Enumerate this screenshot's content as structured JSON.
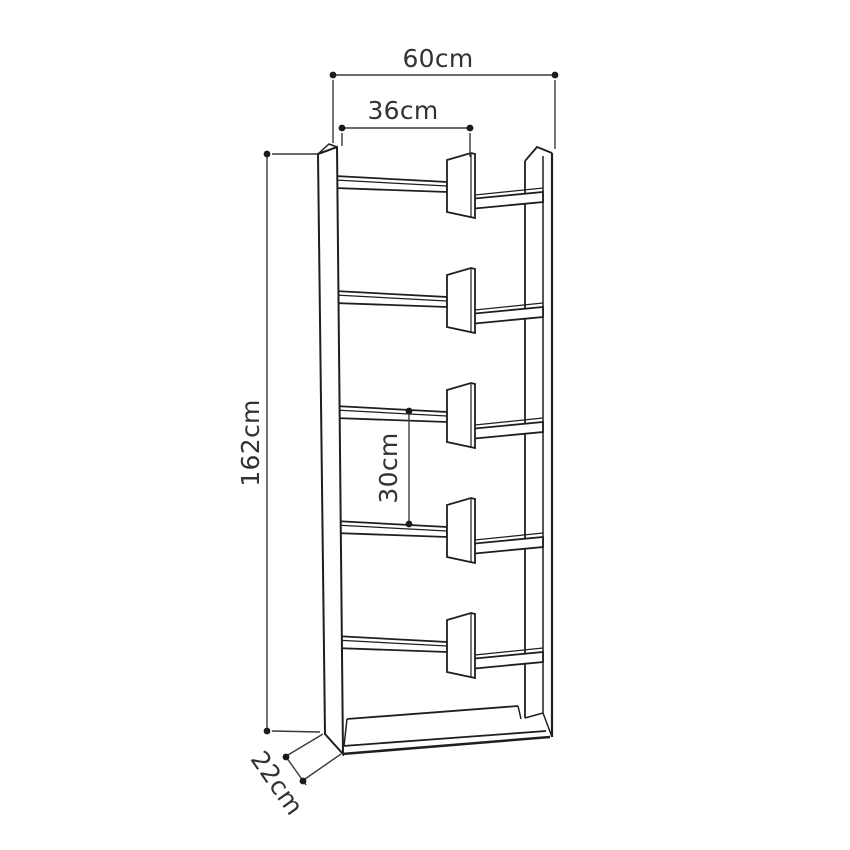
{
  "diagram": {
    "title": "bookcase-dimension-diagram",
    "unit": "cm",
    "shelf_count": 5,
    "labels": {
      "width": "60cm",
      "inner_width": "36cm",
      "height": "162cm",
      "shelf_gap": "30cm",
      "depth": "22cm"
    },
    "values_cm": {
      "width": 60,
      "inner_width": 36,
      "height": 162,
      "shelf_gap": 30,
      "depth": 22
    },
    "colors": {
      "background": "#ffffff",
      "line": "#1f1f1f",
      "dimension": "#3a3a3a",
      "text": "#333333"
    }
  }
}
